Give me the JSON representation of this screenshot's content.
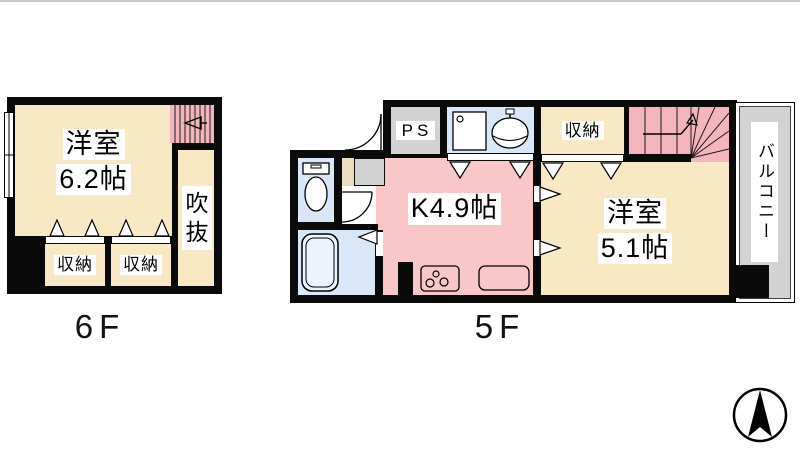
{
  "page": {
    "type": "apartment-floor-plan"
  },
  "floors": {
    "f6": {
      "label": "6F",
      "rooms": {
        "main_name": "洋室",
        "main_size": "6.2帖",
        "void": "吹抜",
        "closet_left": "収納",
        "closet_right": "収納"
      }
    },
    "f5": {
      "label": "5F",
      "rooms": {
        "kitchen": "K4.9帖",
        "pipe_space": "PS",
        "closet": "収納",
        "main_name": "洋室",
        "main_size": "5.1帖",
        "balcony": "バルコニー"
      }
    }
  },
  "icons": {
    "compass": "north-arrow-compass",
    "toilet": "toilet-plan-symbol",
    "bathtub": "bathtub-plan-symbol",
    "washbasin": "washbasin-plan-symbol",
    "washing_machine": "washing-machine-pan-symbol",
    "stove": "gas-stove-burners-symbol",
    "counter": "kitchen-counter-symbol",
    "stairs": "staircase-treads-symbol",
    "window": "window-symbol",
    "door": "door-swing-arc-symbol"
  },
  "colors": {
    "wall": "#0A0A0A",
    "room_cream": "#F9E8C4",
    "kitchen_pink": "#F9C7C7",
    "stair_pink": "#F4B6BC",
    "wet_area_blue": "#DAE7F8",
    "service_gray": "#D3D3D3",
    "entry_tan": "#EADCBB"
  }
}
